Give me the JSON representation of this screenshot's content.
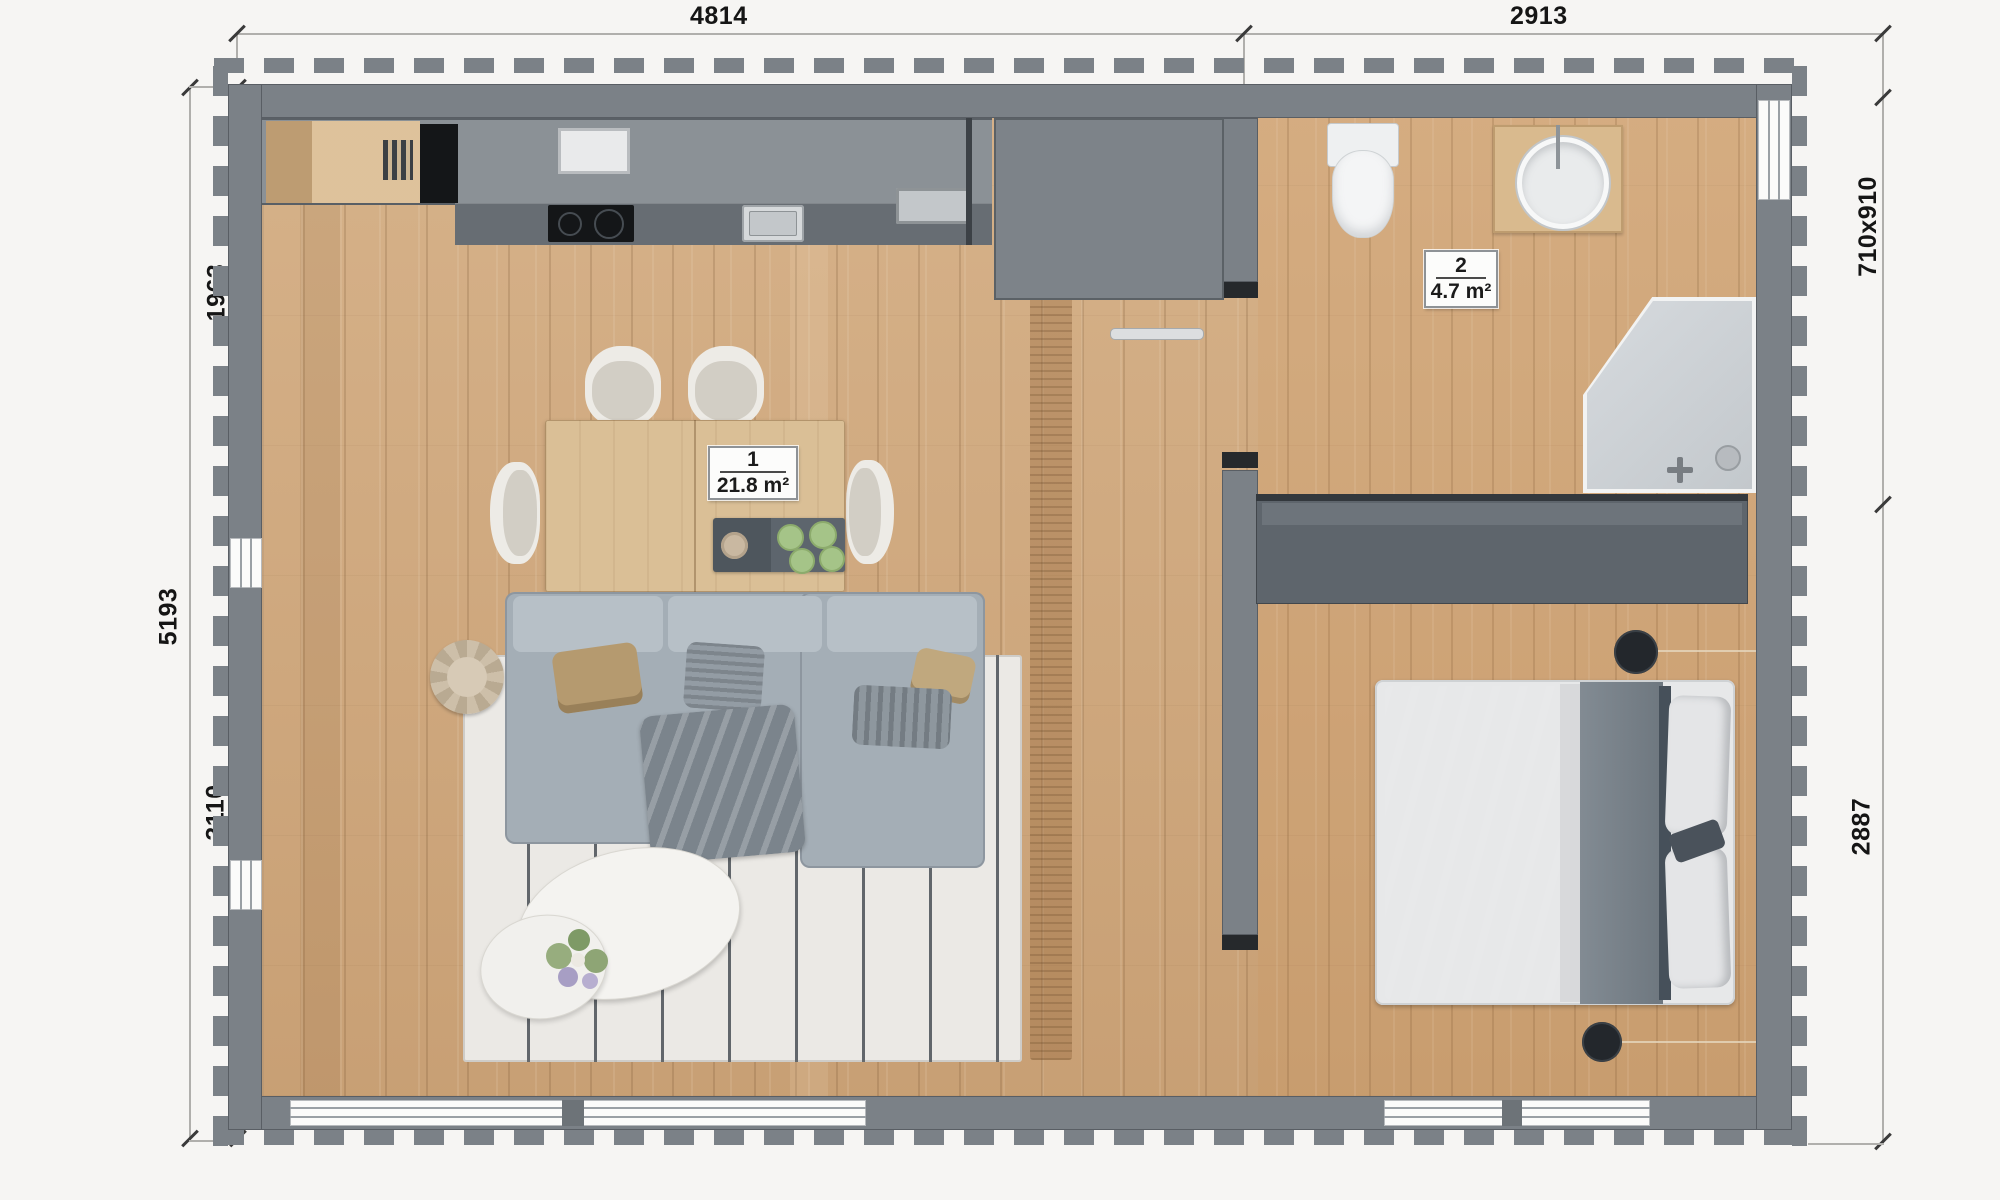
{
  "plan": {
    "type": "apartment-floor-plan-top-view",
    "rooms": [
      {
        "number": "1",
        "area": "21.8 m²",
        "name": "living-room-kitchen"
      },
      {
        "number": "2",
        "area": "4.7 m²",
        "name": "bathroom"
      }
    ],
    "dimensions_mm": {
      "top_left": "4814",
      "top_right": "2913",
      "left_upper": "1963",
      "left_full": "5193",
      "left_lower": "3110",
      "right_window": "710x910",
      "right_lower": "2887"
    },
    "furniture_icons": [
      "kitchen-counter",
      "cooktop",
      "kitchen-sink",
      "cutting-board",
      "tall-cabinet",
      "dining-table",
      "dining-chair",
      "serving-tray",
      "sofa",
      "area-rug",
      "pouf",
      "coffee-table",
      "flower-vase",
      "toilet",
      "vanity-basin",
      "shower",
      "towel-rail",
      "wardrobe",
      "double-bed",
      "pendant-lamp",
      "window",
      "door-opening"
    ]
  },
  "theme": {
    "bg": "#f6f5f3",
    "wall": "#7b8187",
    "floor": "#cfa77c",
    "counter": "#8b9196",
    "counter-dark": "#676d73",
    "appliance-black": "#141618",
    "closet": "#5e656c",
    "shower": "#ccd0d4",
    "bed-purple": "#6e5764",
    "bed-gray": "#79828a",
    "sofa": "#a4aeb6",
    "rug": "#ebe9e5",
    "table-wood": "#dabf96",
    "label-green": "#a5c488"
  }
}
